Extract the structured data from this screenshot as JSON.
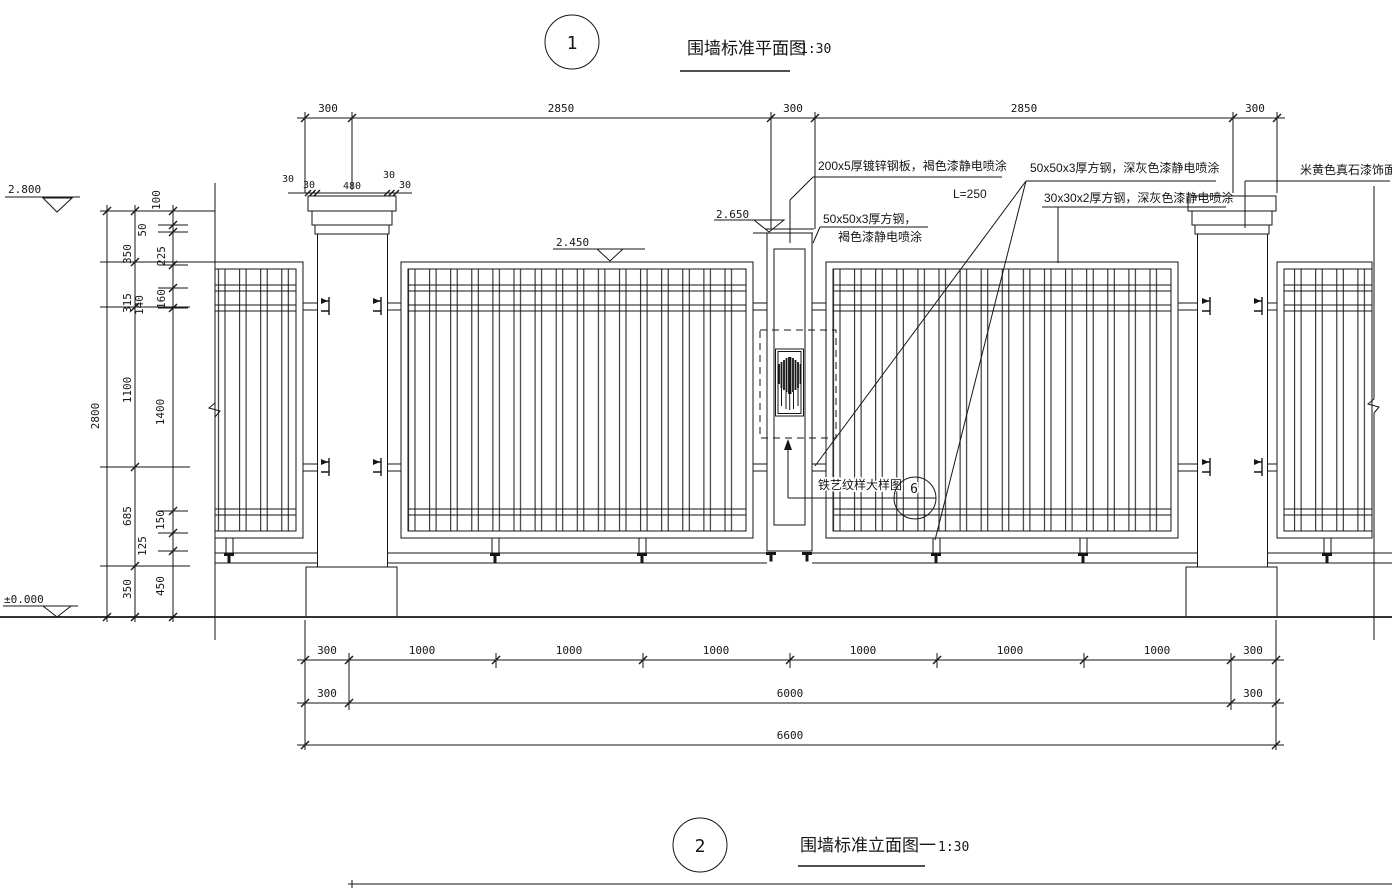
{
  "titles": {
    "t1": {
      "num": "1",
      "label": "围墙标准平面图",
      "scale": "1:30"
    },
    "t2": {
      "num": "2",
      "label": "围墙标准立面图一",
      "scale": "1:30"
    }
  },
  "levels": {
    "top": "2.800",
    "panel": "2.450",
    "gate": "2.650",
    "ground": "±0.000"
  },
  "ann": {
    "plate": "200x5厚镀锌钢板，褐色漆静电喷涂",
    "plate_len": "L=250",
    "tube50_gray": "50x50x3厚方钢，深灰色漆静电喷涂",
    "tube30_gray": "30x30x2厚方钢，深灰色漆静电喷涂",
    "tube50_brown_1": "50x50x3厚方钢，",
    "tube50_brown_2": "褐色漆静电喷涂",
    "stone": "米黄色真石漆饰面",
    "detail_label": "铁艺纹样大样图",
    "detail_num": "6"
  },
  "dims": {
    "top": [
      "300",
      "2850",
      "300",
      "2850",
      "300"
    ],
    "cap": [
      "30",
      "30",
      "480",
      "30",
      "30"
    ],
    "b1": [
      "300",
      "1000",
      "1000",
      "1000",
      "1000",
      "1000",
      "1000",
      "300"
    ],
    "b2": [
      "300",
      "6000",
      "300"
    ],
    "b3": [
      "6600"
    ],
    "left_total": "2800",
    "left_mid": [
      "350",
      "315",
      "1100",
      "685",
      "350"
    ],
    "left_inner": [
      "100",
      "50",
      "225",
      "160",
      "140",
      "1400",
      "150",
      "125",
      "450"
    ]
  }
}
